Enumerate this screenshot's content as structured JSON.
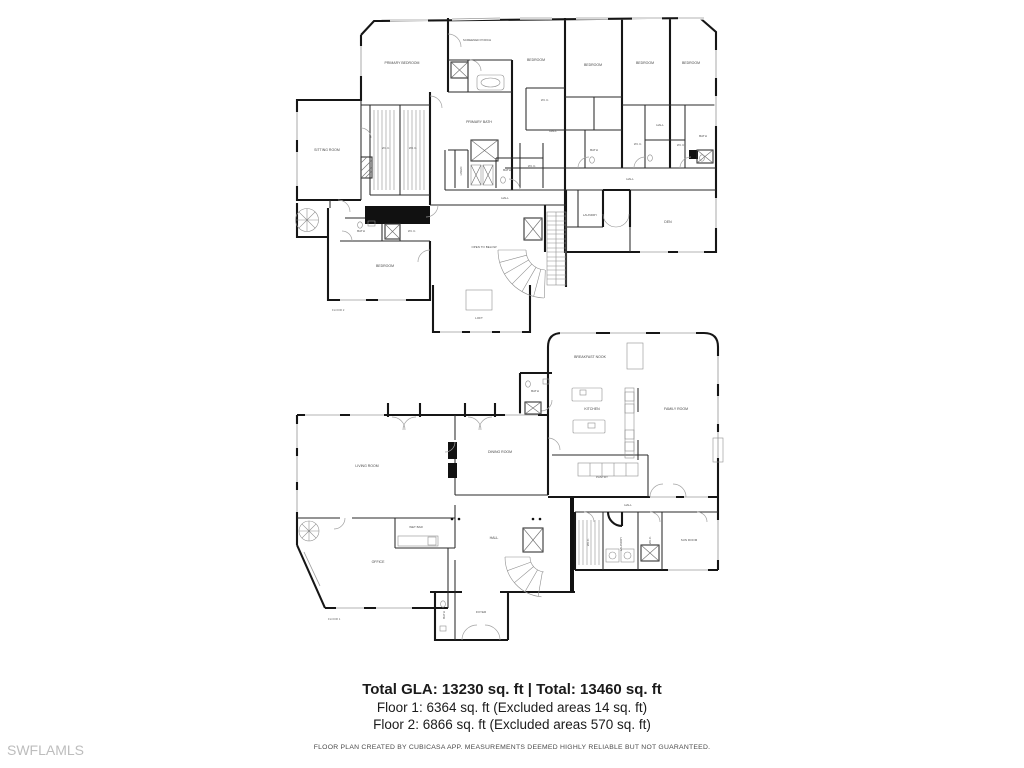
{
  "watermark": "SWFLAMLS",
  "summary": {
    "total_line": "Total GLA: 13230 sq. ft | Total: 13460 sq. ft",
    "floor1_line": "Floor 1: 6364 sq. ft (Excluded areas 14 sq. ft)",
    "floor2_line": "Floor 2: 6866 sq. ft (Excluded areas 570 sq. ft)",
    "disclaimer": "FLOOR PLAN CREATED BY CUBICASA APP. MEASUREMENTS DEEMED HIGHLY RELIABLE BUT NOT GUARANTEED."
  },
  "colors": {
    "wall_ink": "#161616",
    "label_gray": "#474747",
    "watermark_gray": "#bdbdbd"
  },
  "floor2": {
    "tag": "FLOOR 2",
    "rooms": [
      {
        "label": "PRIMARY BEDROOM"
      },
      {
        "label": "SCREENED PORCH"
      },
      {
        "label": "BEDROOM"
      },
      {
        "label": "BEDROOM"
      },
      {
        "label": "BEDROOM"
      },
      {
        "label": "BEDROOM"
      },
      {
        "label": "SITTING ROOM"
      },
      {
        "label": "W.I.C."
      },
      {
        "label": "W.I.C."
      },
      {
        "label": "PRIMARY BATH"
      },
      {
        "label": "W.I.C."
      },
      {
        "label": "HALL"
      },
      {
        "label": "BATH"
      },
      {
        "label": "W.I.C."
      },
      {
        "label": "HALL"
      },
      {
        "label": "W.I.C."
      },
      {
        "label": "BATH"
      },
      {
        "label": "LINEN"
      },
      {
        "label": "BATH"
      },
      {
        "label": "W.I.C."
      },
      {
        "label": "HALL"
      },
      {
        "label": "HALL"
      },
      {
        "label": "LAUNDRY"
      },
      {
        "label": "DEN"
      },
      {
        "label": "BATH"
      },
      {
        "label": "W.I.C."
      },
      {
        "label": "BEDROOM"
      },
      {
        "label": "OPEN TO BELOW"
      },
      {
        "label": "LOFT"
      }
    ]
  },
  "floor1": {
    "tag": "FLOOR 1",
    "rooms": [
      {
        "label": "BREAKFAST NOOK"
      },
      {
        "label": "KITCHEN"
      },
      {
        "label": "FAMILY ROOM"
      },
      {
        "label": "BATH"
      },
      {
        "label": "PANTRY"
      },
      {
        "label": "LIVING ROOM"
      },
      {
        "label": "DINING ROOM"
      },
      {
        "label": "WET BAR"
      },
      {
        "label": "OFFICE"
      },
      {
        "label": "HALL"
      },
      {
        "label": "FOYER"
      },
      {
        "label": "BATH"
      },
      {
        "label": "HALL"
      },
      {
        "label": "W.I.C."
      },
      {
        "label": "LAUNDRY"
      },
      {
        "label": "W.I.C."
      },
      {
        "label": "SUN ROOM"
      }
    ]
  }
}
